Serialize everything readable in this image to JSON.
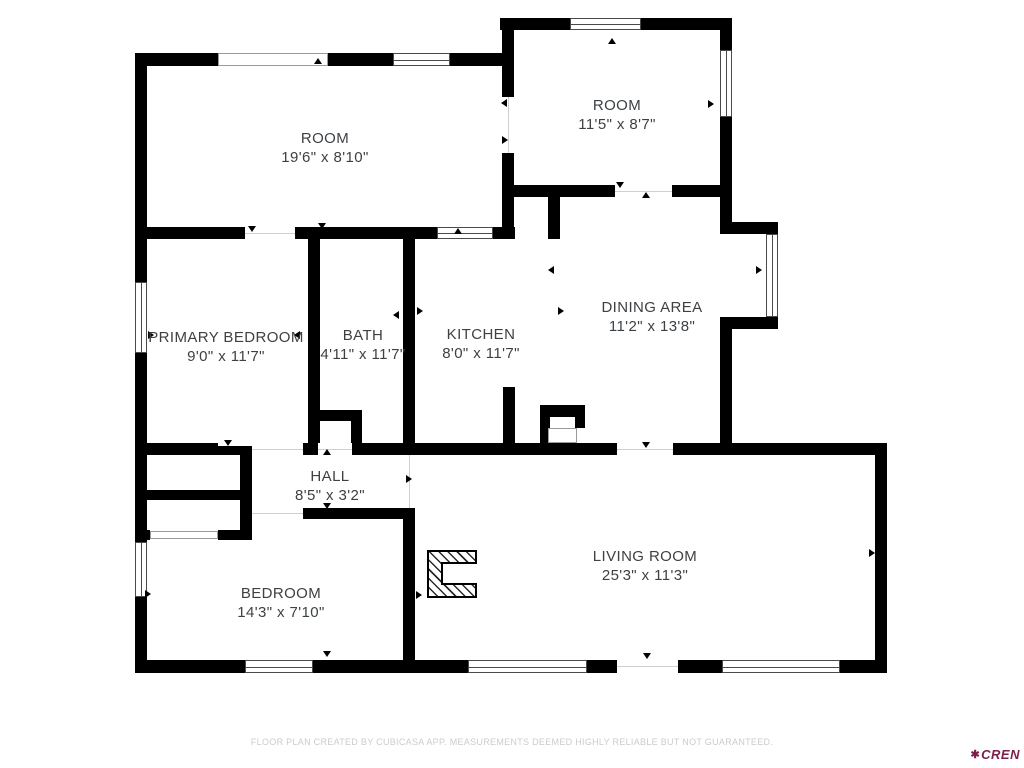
{
  "meta": {
    "wall_color": "#000000",
    "label_color": "#3d4144",
    "footer_color": "#cacccd",
    "logo_color": "#7c1f4a",
    "background": "#ffffff"
  },
  "rooms": [
    {
      "name": "ROOM",
      "dims": "19'6\" x 8'10\""
    },
    {
      "name": "ROOM",
      "dims": "11'5\" x 8'7\""
    },
    {
      "name": "PRIMARY BEDROOM",
      "dims": "9'0\" x 11'7\""
    },
    {
      "name": "BATH",
      "dims": "4'11\" x 11'7\""
    },
    {
      "name": "KITCHEN",
      "dims": "8'0\" x 11'7\""
    },
    {
      "name": "DINING AREA",
      "dims": "11'2\" x 13'8\""
    },
    {
      "name": "HALL",
      "dims": "8'5\" x 3'2\""
    },
    {
      "name": "BEDROOM",
      "dims": "14'3\" x 7'10\""
    },
    {
      "name": "LIVING ROOM",
      "dims": "25'3\" x 11'3\""
    }
  ],
  "footer": {
    "disclaimer": "FLOOR PLAN CREATED BY CUBICASA APP. MEASUREMENTS DEEMED HIGHLY RELIABLE BUT NOT GUARANTEED."
  },
  "logo": {
    "mark": "✱",
    "text": "CREN"
  }
}
